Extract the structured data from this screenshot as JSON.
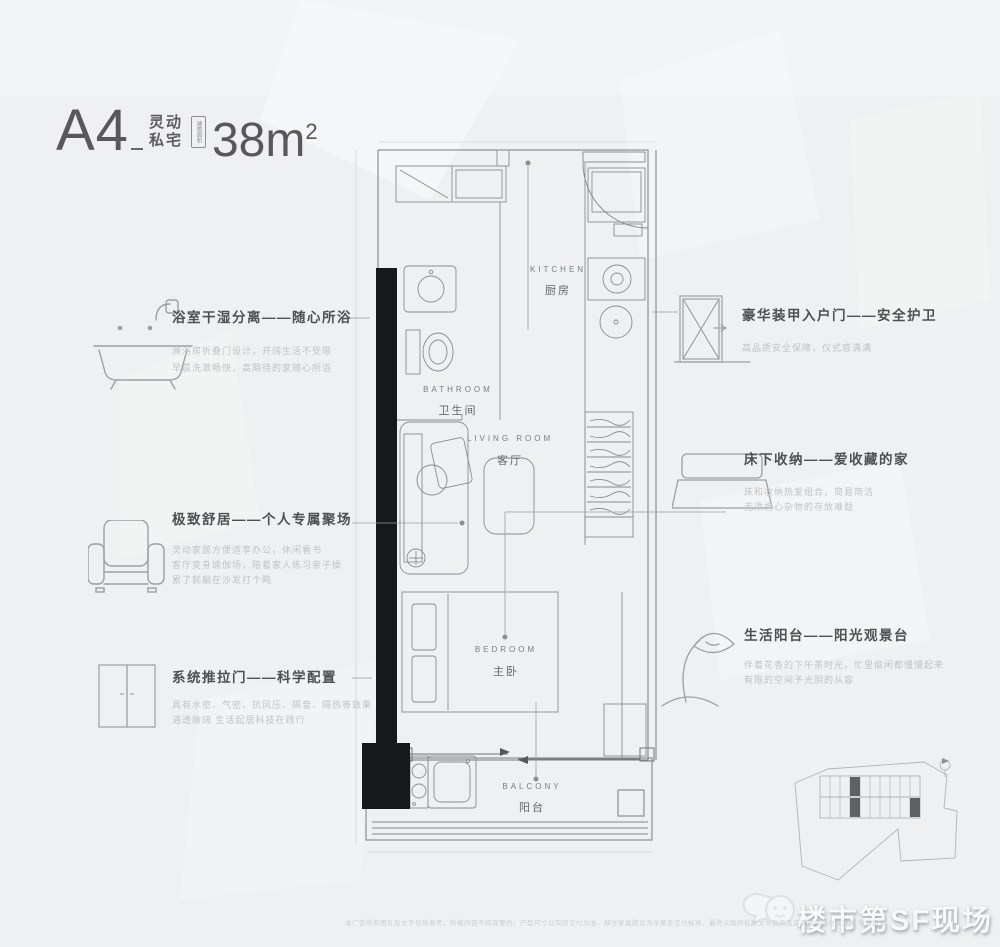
{
  "header": {
    "unit": "A4",
    "tagline_line1": "灵动",
    "tagline_line2": "私宅",
    "area_badge": "建筑面积",
    "area_value": "38m",
    "area_sup": "2"
  },
  "plan": {
    "rooms": [
      {
        "en": "KITCHEN",
        "zh": "厨房"
      },
      {
        "en": "BATHROOM",
        "zh": "卫生间"
      },
      {
        "en": "LIVING ROOM",
        "zh": "客厅"
      },
      {
        "en": "BEDROOM",
        "zh": "主卧"
      },
      {
        "en": "BALCONY",
        "zh": "阳台"
      }
    ]
  },
  "annotations": {
    "left": [
      {
        "title": "浴室干湿分离——随心所浴",
        "desc": [
          "淋浴房折叠门设计，开阔生活不受限",
          "早晨洗漱畅快，高期待的家随心所浴"
        ]
      },
      {
        "title": "极致舒居——个人专属聚场",
        "desc": [
          "灵动家居方便适享办公，休闲看书",
          "客厅变身瑜伽场，陪着家人练习亲子操",
          "累了就躺在沙发打个盹"
        ]
      },
      {
        "title": "系统推拉门——科学配置",
        "desc": [
          "具有水密、气密、抗风压、隔音、隔热等效果",
          "通透敞阔 生活起居科技在践行"
        ]
      }
    ],
    "right": [
      {
        "title": "豪华装甲入户门——安全护卫",
        "desc": [
          "高品质安全保障，仪式感满满"
        ]
      },
      {
        "title": "床下收纳——爱收藏的家",
        "desc": [
          "床和收纳热爱组合，简易简洁",
          "无须担心杂物的存放难题"
        ]
      },
      {
        "title": "生活阳台——阳光观景台",
        "desc": [
          "伴着花香的下午茶时光，忙里偷闲都慢慢起来",
          "有限的空间予光阴的从容"
        ]
      }
    ]
  },
  "watermark": "楼市第SF现场",
  "disclaimer": "本广告所有图片及文字仅供参考，所载内容不构成要约，户型尺寸以实际交付为准，部分家具陈设为示意非交付标准，最终以政府批准文件及商品房买卖合同约定为准 敬请留意"
}
